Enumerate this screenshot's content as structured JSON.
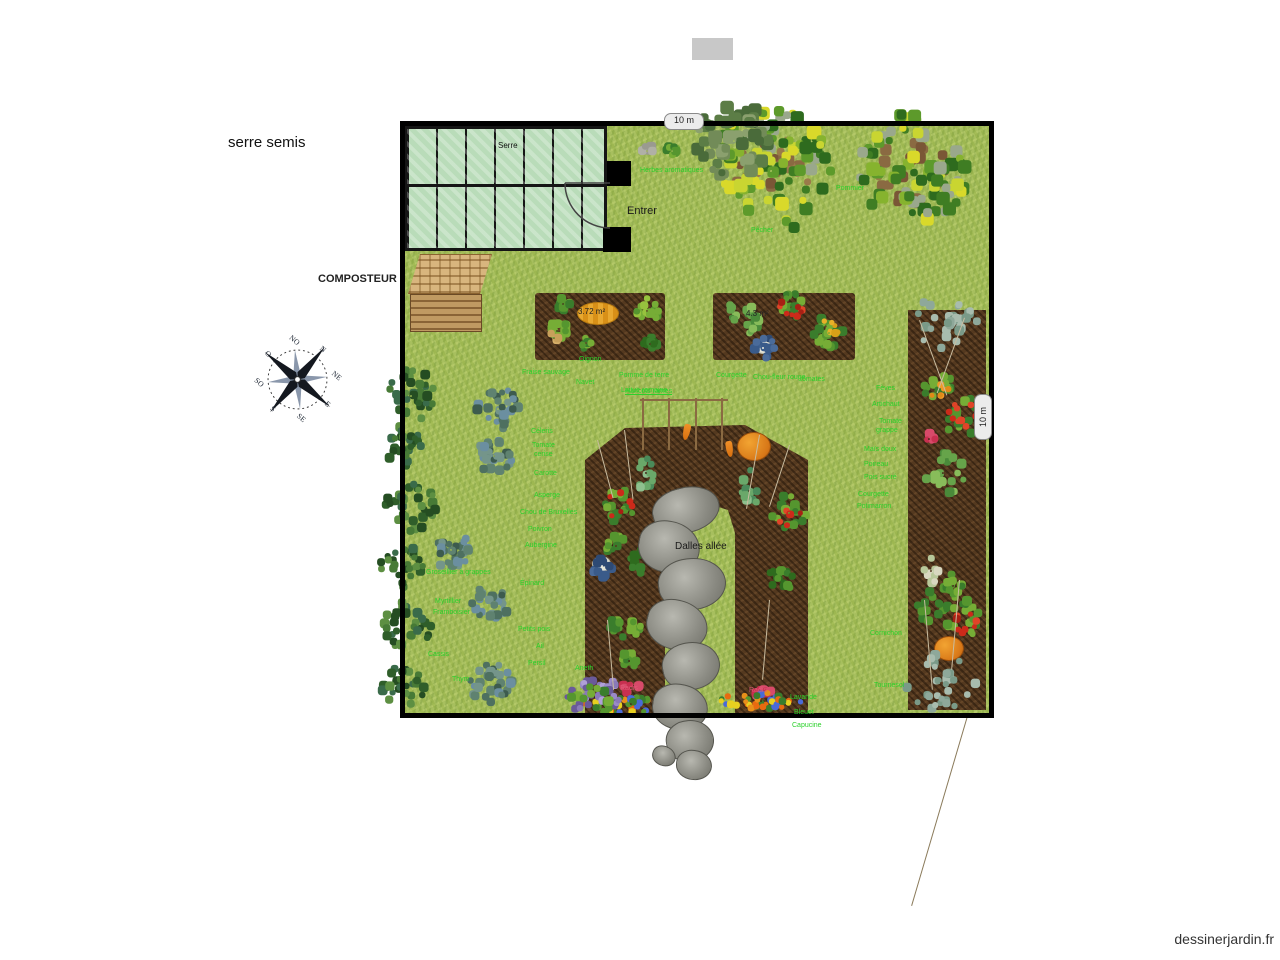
{
  "page": {
    "watermark": "dessinerjardin.fr",
    "accent_green": "#2bd12b",
    "label_pink": "#e05a78"
  },
  "plan": {
    "title": "serre semis",
    "greenhouse_label": "Serre",
    "entrance_label": "Entrer",
    "composter_label": "COMPOSTEUR",
    "path_label": "Dalles allée",
    "dim_top": "10 m",
    "dim_right": "10 m",
    "bed1_area": "3.72 m²",
    "bed2_area": "4.3 m²"
  },
  "compass": {
    "directions": [
      "N",
      "NE",
      "E",
      "SE",
      "S",
      "SO",
      "O",
      "NO"
    ]
  },
  "plant_labels": [
    {
      "text": "Herbes aromatiques",
      "x": 640,
      "y": 167,
      "c": "g"
    },
    {
      "text": "Pommier",
      "x": 836,
      "y": 185,
      "c": "g"
    },
    {
      "text": "Pêcher",
      "x": 751,
      "y": 227,
      "c": "g"
    },
    {
      "text": "Oignon",
      "x": 579,
      "y": 356,
      "c": "g"
    },
    {
      "text": "Fraise sauvage",
      "x": 522,
      "y": 369,
      "c": "g"
    },
    {
      "text": "Navet",
      "x": 576,
      "y": 379,
      "c": "g"
    },
    {
      "text": "Pomme de terre",
      "x": 619,
      "y": 372,
      "c": "g"
    },
    {
      "text": "Laitue romaine",
      "x": 621,
      "y": 387,
      "c": "g"
    },
    {
      "text": "Courgette",
      "x": 716,
      "y": 372,
      "c": "g"
    },
    {
      "text": "Chou-fleur rouge",
      "x": 753,
      "y": 374,
      "c": "g"
    },
    {
      "text": "tomates",
      "x": 800,
      "y": 376,
      "c": "g"
    },
    {
      "text": "Haricots rames",
      "x": 625,
      "y": 388,
      "c": "g",
      "u": 1
    },
    {
      "text": "Céleris",
      "x": 531,
      "y": 428,
      "c": "g"
    },
    {
      "text": "Tomate",
      "x": 532,
      "y": 442,
      "c": "g"
    },
    {
      "text": "cerise",
      "x": 534,
      "y": 451,
      "c": "g"
    },
    {
      "text": "Carotte",
      "x": 534,
      "y": 470,
      "c": "g"
    },
    {
      "text": "Asperge",
      "x": 534,
      "y": 492,
      "c": "g"
    },
    {
      "text": "Chou de Bruxelles",
      "x": 520,
      "y": 509,
      "c": "g"
    },
    {
      "text": "Poivron",
      "x": 528,
      "y": 526,
      "c": "g"
    },
    {
      "text": "Aubergine",
      "x": 525,
      "y": 542,
      "c": "g"
    },
    {
      "text": "Groseillier à grappes",
      "x": 426,
      "y": 569,
      "c": "g"
    },
    {
      "text": "Épinard",
      "x": 520,
      "y": 580,
      "c": "g"
    },
    {
      "text": "Myrtillier",
      "x": 435,
      "y": 598,
      "c": "g"
    },
    {
      "text": "Framboisier",
      "x": 433,
      "y": 609,
      "c": "g"
    },
    {
      "text": "Petits pois",
      "x": 518,
      "y": 626,
      "c": "g"
    },
    {
      "text": "Ail",
      "x": 536,
      "y": 643,
      "c": "g"
    },
    {
      "text": "Persil",
      "x": 528,
      "y": 660,
      "c": "g"
    },
    {
      "text": "Cassis",
      "x": 428,
      "y": 651,
      "c": "g"
    },
    {
      "text": "Thym",
      "x": 452,
      "y": 676,
      "c": "g"
    },
    {
      "text": "Aneth",
      "x": 575,
      "y": 665,
      "c": "g"
    },
    {
      "text": "Lavande",
      "x": 790,
      "y": 694,
      "c": "g"
    },
    {
      "text": "Bleuet",
      "x": 794,
      "y": 709,
      "c": "g"
    },
    {
      "text": "Capucine",
      "x": 792,
      "y": 722,
      "c": "g"
    },
    {
      "text": "Fèves",
      "x": 876,
      "y": 385,
      "c": "g"
    },
    {
      "text": "Artichaut",
      "x": 872,
      "y": 401,
      "c": "g"
    },
    {
      "text": "Tomate",
      "x": 879,
      "y": 418,
      "c": "g"
    },
    {
      "text": "grappe",
      "x": 876,
      "y": 427,
      "c": "g"
    },
    {
      "text": "Maïs doux",
      "x": 864,
      "y": 446,
      "c": "g"
    },
    {
      "text": "Poireau",
      "x": 864,
      "y": 461,
      "c": "g"
    },
    {
      "text": "Pois sucré",
      "x": 864,
      "y": 474,
      "c": "g"
    },
    {
      "text": "Courgette",
      "x": 858,
      "y": 491,
      "c": "g"
    },
    {
      "text": "Potimarron",
      "x": 857,
      "y": 503,
      "c": "g"
    },
    {
      "text": "Cornichon",
      "x": 870,
      "y": 630,
      "c": "g"
    },
    {
      "text": "Tournesol",
      "x": 874,
      "y": 682,
      "c": "g"
    },
    {
      "text": "Radis",
      "x": 620,
      "y": 685,
      "c": "p"
    },
    {
      "text": "Radis",
      "x": 749,
      "y": 687,
      "c": "p"
    }
  ]
}
